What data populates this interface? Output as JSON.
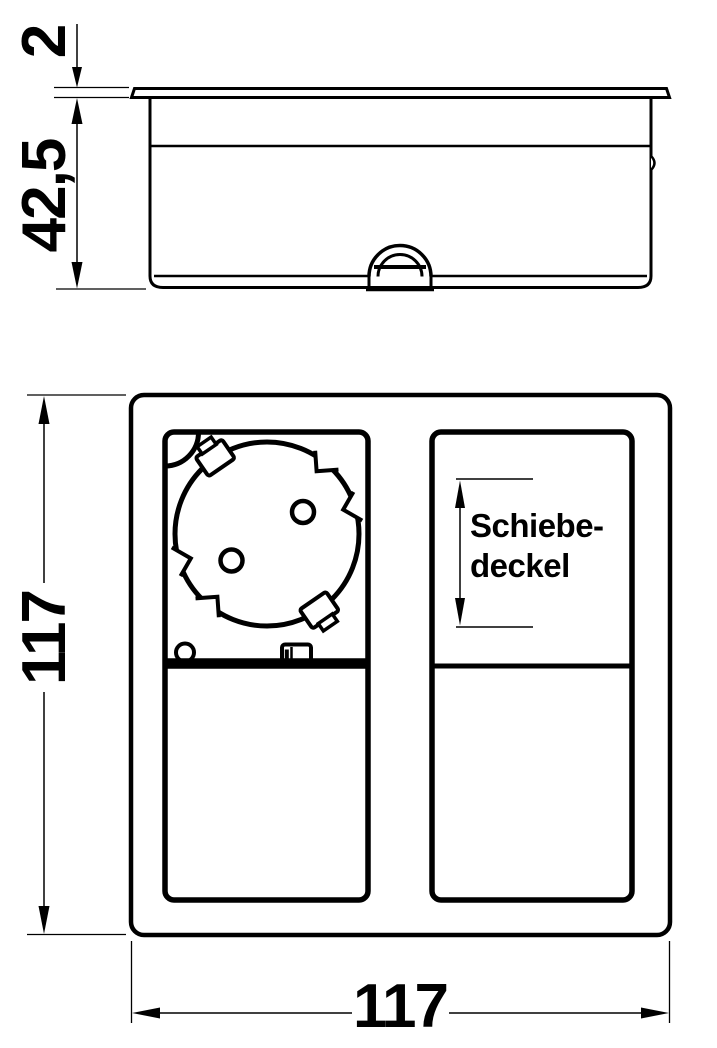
{
  "drawing": {
    "views": {
      "side_view": "socket unit side elevation",
      "top_view": "socket unit plan view with schuko outlet and sliding cover"
    },
    "dimensions": {
      "cover_thickness": "2",
      "body_height": "42,5",
      "overall_height": "117",
      "overall_width": "117"
    },
    "labels": {
      "sliding_cover_line1": "Schiebe-",
      "sliding_cover_line2": "deckel"
    },
    "colors": {
      "line": "#000000",
      "background": "#ffffff"
    }
  }
}
